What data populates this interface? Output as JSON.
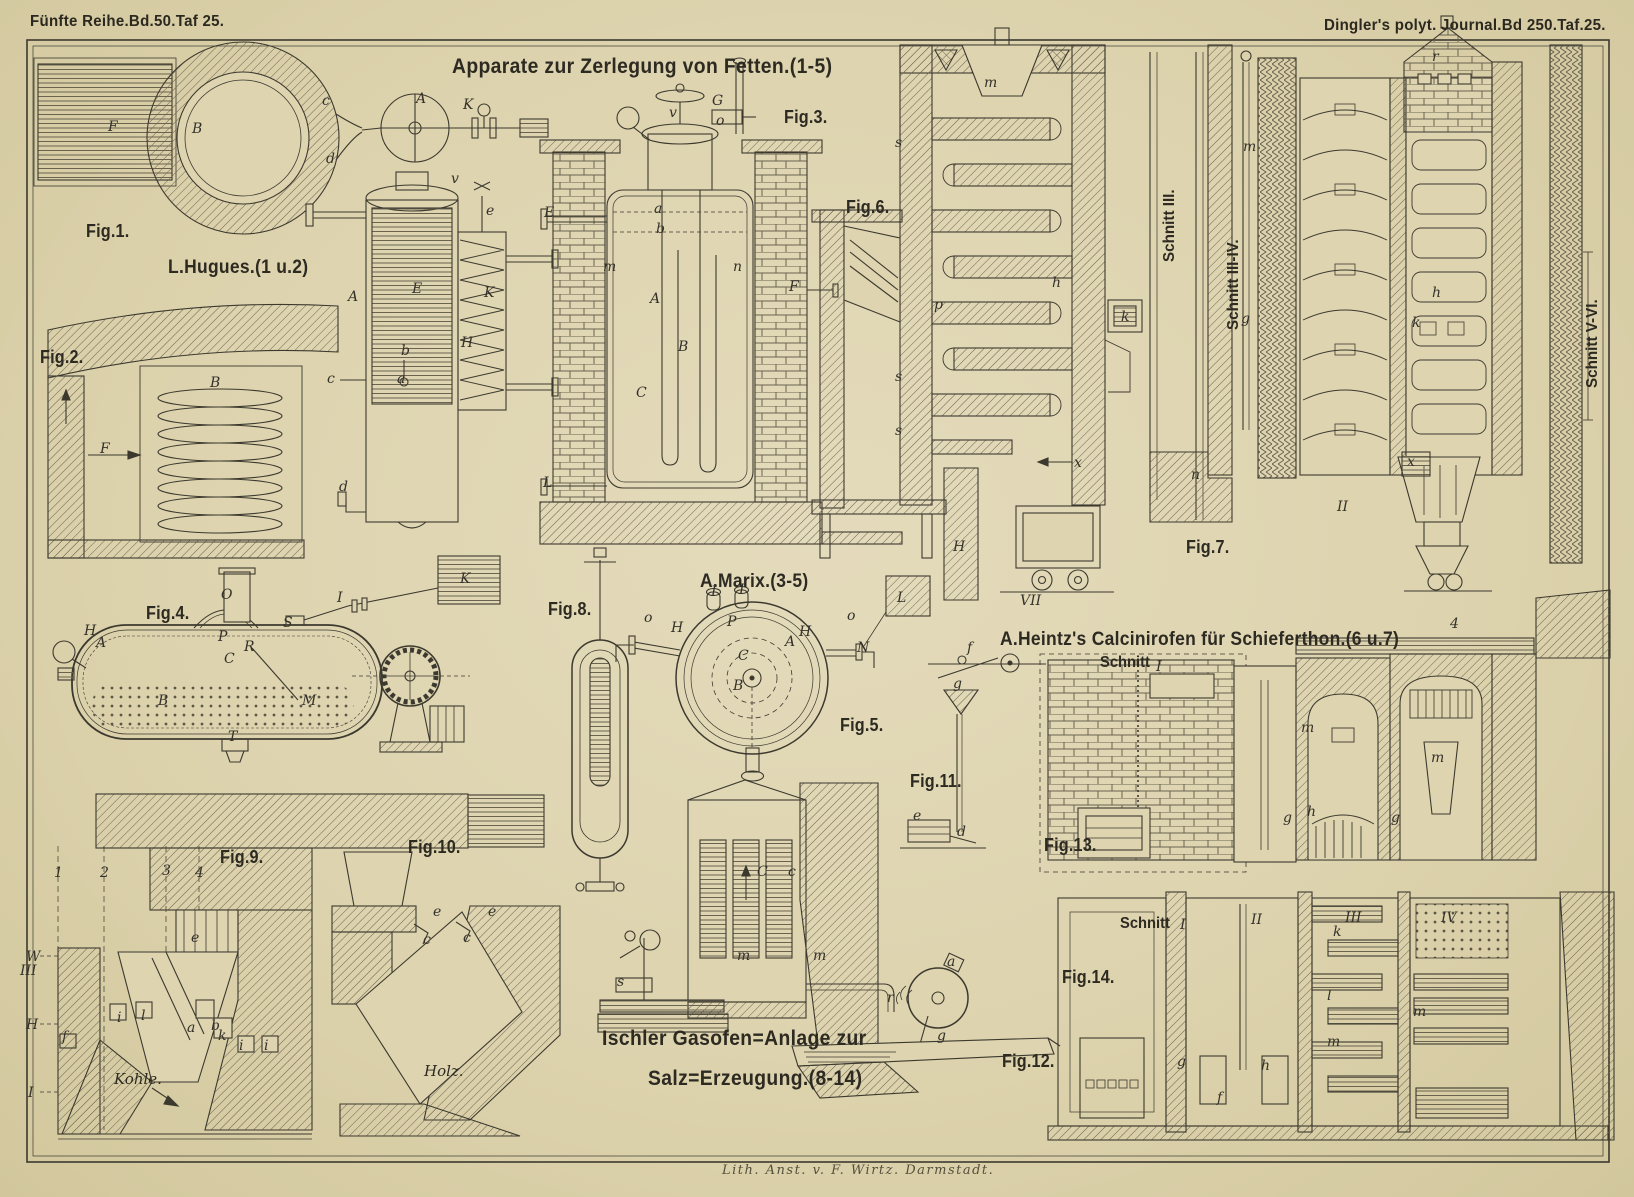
{
  "header": {
    "left": "Fünfte Reihe.Bd.50.Taf 25.",
    "right": "Dingler's polyt. Journal.Bd 250.Taf.25."
  },
  "titles": {
    "main": "Apparate zur Zerlegung von Fetten.(1-5)",
    "hugues": "L.Hugues.(1 u.2)",
    "marix": "A.Marix.(3-5)",
    "heintz": "A.Heintz's Calcinirofen für Schieferthon.(6 u.7)",
    "ischler_line1": "Ischler Gasofen=Anlage zur",
    "ischler_line2": "Salz=Erzeugung.(8-14)",
    "credit": "Lith. Anst. v. F. Wirtz. Darmstadt."
  },
  "figs": [
    "Fig.1.",
    "Fig.2.",
    "Fig.3.",
    "Fig.4.",
    "Fig.5.",
    "Fig.6.",
    "Fig.7.",
    "Fig.8.",
    "Fig.9.",
    "Fig.10.",
    "Fig.11.",
    "Fig.12.",
    "Fig.13.",
    "Fig.14."
  ],
  "sections": {
    "schnitt_3": "Schnitt III.",
    "schnitt_3_4": "Schnitt III-IV.",
    "schnitt_5_6": "Schnitt V-VI.",
    "schnitt_13": "Schnitt",
    "schnitt_14": "Schnitt",
    "kohle": "Kohle.",
    "holz": "Holz."
  },
  "numerals": [
    "I",
    "II",
    "III",
    "IV"
  ],
  "letters": [
    "F",
    "B",
    "c",
    "d",
    "A",
    "K",
    "B",
    "F",
    "A",
    "E",
    "K",
    "H",
    "b",
    "a",
    "c",
    "d",
    "v",
    "e",
    "E",
    "v",
    "G",
    "o",
    "a",
    "b",
    "m",
    "n",
    "A",
    "B",
    "C",
    "F",
    "L",
    "m",
    "s",
    "p",
    "h",
    "k",
    "s",
    "s",
    "x",
    "H",
    "VII",
    "m",
    "g",
    "n",
    "x",
    "h",
    "k",
    "r",
    "II",
    "O",
    "S",
    "I",
    "K",
    "H",
    "A",
    "P",
    "R",
    "C",
    "B",
    "M",
    "T",
    "I",
    "I",
    "o",
    "H",
    "P",
    "A",
    "H",
    "C",
    "B",
    "N",
    "L",
    "o",
    "f",
    "g",
    "e",
    "d",
    "m",
    "g",
    "h",
    "g",
    "m",
    "4",
    "e",
    "a",
    "b",
    "k",
    "i",
    "l",
    "i",
    "i",
    "W",
    "III",
    "H",
    "I",
    "f",
    "1",
    "2",
    "3",
    "4",
    "e",
    "c",
    "e",
    "c",
    "C",
    "c",
    "m",
    "m",
    "s",
    "a",
    "r",
    "g",
    "k",
    "l",
    "m",
    "m",
    "g",
    "h",
    "f",
    "I"
  ],
  "colors": {
    "paper": "#ded4b0",
    "ink": "#3c392f"
  }
}
